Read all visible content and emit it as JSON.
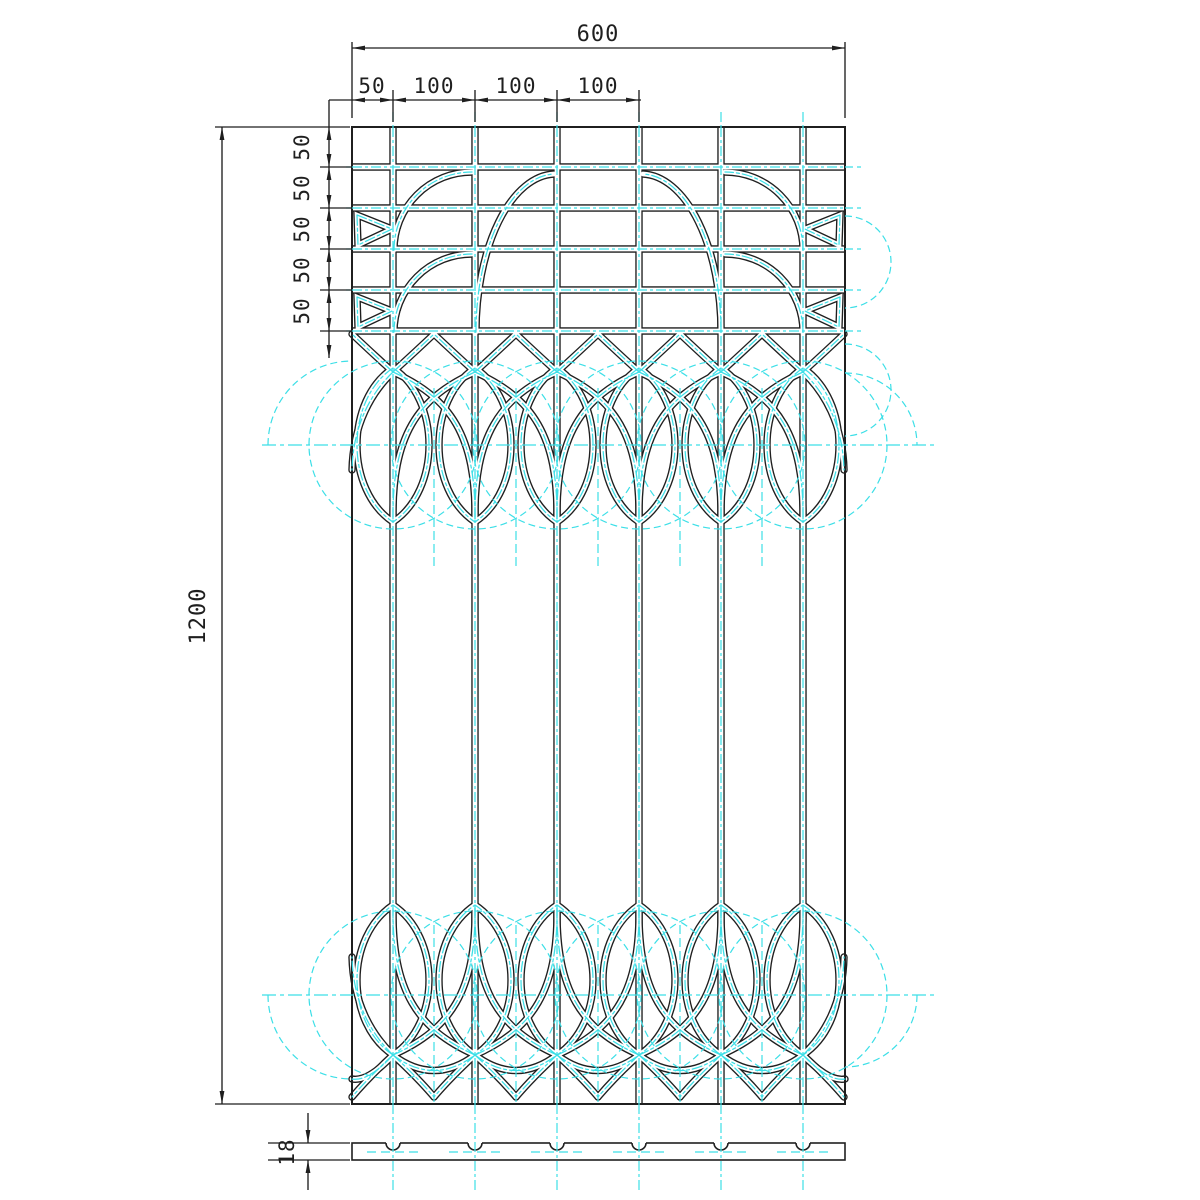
{
  "drawing": {
    "type": "cad-technical-drawing",
    "subject": "decorative wrought grille panel - front view with bottom section view",
    "background": "#ffffff",
    "line_color": "#1f1f1f",
    "construction_color": "#3cdfe7"
  },
  "dimensions": {
    "overall_width": "600",
    "top_chain": [
      "50",
      "100",
      "100",
      "100"
    ],
    "left_chain": [
      "50",
      "50",
      "50",
      "50",
      "50"
    ],
    "overall_height": "1200",
    "section_thickness": "18"
  },
  "geometry": {
    "panel": {
      "left": 352,
      "right": 845,
      "top": 127,
      "bottom": 1104
    },
    "mirror_axis": 1197,
    "bars": [
      393,
      475,
      557,
      639,
      721,
      803
    ],
    "rows": [
      167,
      208,
      249,
      290,
      331
    ],
    "mids": [
      434,
      516,
      598,
      680,
      762
    ],
    "drop": {
      "top_tip": 368,
      "top_bottom": 522,
      "top_cy": 445,
      "bot_tip": 1055,
      "bot_top": 905,
      "bot_cy": 995,
      "bulge": 48
    },
    "circle_r": 84,
    "slab": {
      "top": 1143,
      "bottom": 1160,
      "notch_r": 7
    },
    "fronds": [
      "M394 250 A78 78 0 0 1 472 172",
      "M394 332 A78 78 0 0 1 472 254",
      "M476 332 A80 158 0 0 1 554 174"
    ],
    "wedges": [
      "M357 215 L392 229 L358 245 Z",
      "M357 297 L392 311 L358 327 Z"
    ]
  }
}
